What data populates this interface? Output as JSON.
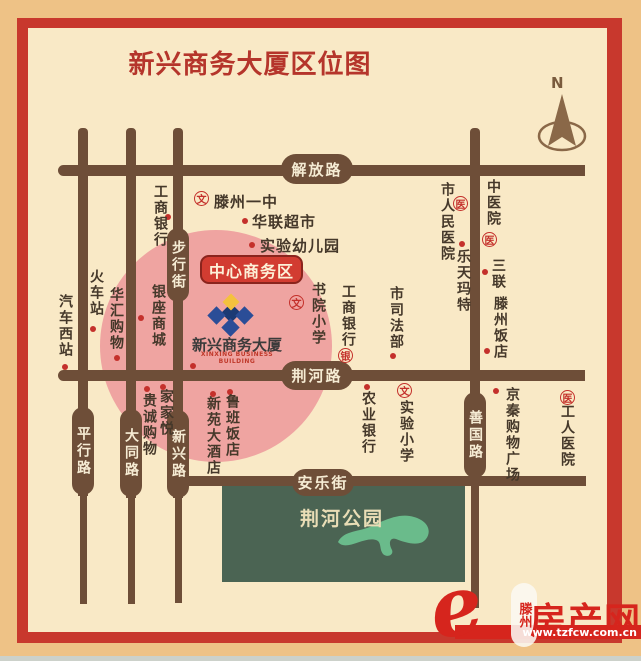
{
  "title": "新兴商务大厦区位图",
  "compass": {
    "north_label": "N"
  },
  "cbd": {
    "badge_label": "中心商务区"
  },
  "building": {
    "name": "新兴商务大厦",
    "name_en": "XINXING BUSINESS BUILDING"
  },
  "roads": {
    "jiefang": "解放路",
    "jinghe": "荆河路",
    "anle": "安乐街",
    "buxingjie": "步行街",
    "pingxing": "平行路",
    "datong": "大同路",
    "xinxing": "新兴路",
    "shanguo": "善国路"
  },
  "park": {
    "name": "荆河公园"
  },
  "legend_glyphs": {
    "school": "文",
    "hospital": "医",
    "bank": "银"
  },
  "pois": [
    {
      "label": "滕州一中",
      "marker": "school"
    },
    {
      "label": "华联超市",
      "marker": "dot"
    },
    {
      "label": "实验幼儿园",
      "marker": "dot"
    },
    {
      "label": "工商银行",
      "marker": "dot"
    },
    {
      "label": "汽车西站",
      "marker": "dot"
    },
    {
      "label": "火车站",
      "marker": "dot"
    },
    {
      "label": "华汇购物",
      "marker": "dot"
    },
    {
      "label": "银座商城",
      "marker": "dot"
    },
    {
      "label": "书院小学",
      "marker": "school"
    },
    {
      "label": "工商银行",
      "marker": "bank"
    },
    {
      "label": "市司法部",
      "marker": "dot"
    },
    {
      "label": "市人民医院",
      "marker": "hospital"
    },
    {
      "label": "中医院",
      "marker": "hospital"
    },
    {
      "label": "乐天玛特",
      "marker": "dot"
    },
    {
      "label": "三联",
      "marker": "dot"
    },
    {
      "label": "滕州饭店",
      "marker": "dot"
    },
    {
      "label": "贵诚购物",
      "marker": "dot"
    },
    {
      "label": "家家悦",
      "marker": "dot"
    },
    {
      "label": "新苑大酒店",
      "marker": "dot"
    },
    {
      "label": "鲁班饭店",
      "marker": "dot"
    },
    {
      "label": "农业银行",
      "marker": "dot"
    },
    {
      "label": "实验小学",
      "marker": "school"
    },
    {
      "label": "京秦购物广场",
      "marker": "dot"
    },
    {
      "label": "工人医院",
      "marker": "hospital"
    }
  ],
  "watermark": {
    "logo_letter": "e",
    "city": "滕州",
    "brand": "房产网",
    "url": "www.tzfcw.com.cn"
  },
  "colors": {
    "outer_bg": "#eec286",
    "frame_red": "#c8382d",
    "map_bg": "#f9e9c6",
    "road_brown": "#6e4e38",
    "cbd_pink": "#efa4a1",
    "park_green": "#4b6453",
    "lake_green": "#6abb8b",
    "marker_red": "#c4302b",
    "title_red": "#b5352b",
    "watermark_red": "#d6251d"
  }
}
